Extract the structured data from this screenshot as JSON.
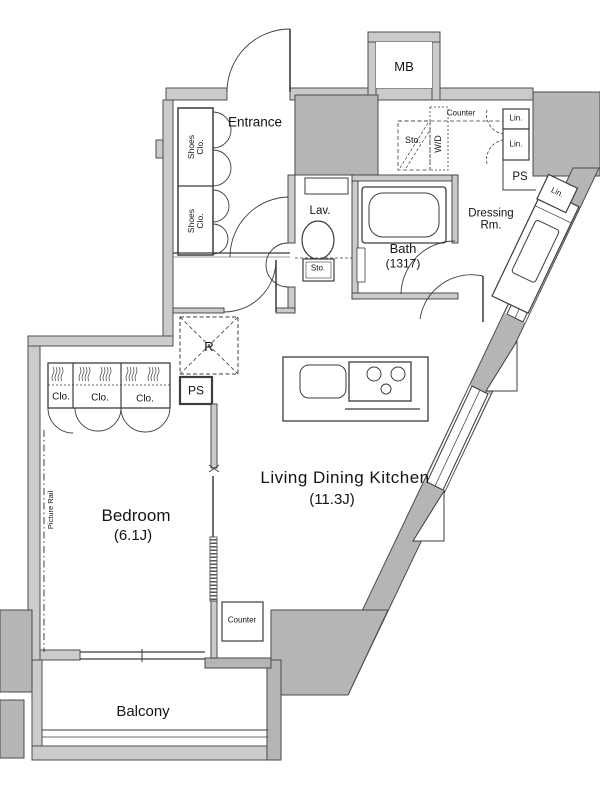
{
  "plan": {
    "rooms": {
      "entrance": "Entrance",
      "bedroom": "Bedroom",
      "bedroom_size": "(6.1J)",
      "ldk": "Living Dining Kitchen",
      "ldk_size": "(11.3J)",
      "bath": "Bath",
      "bath_size": "(1317)",
      "lav": "Lav.",
      "dressing": "Dressing Rm.",
      "balcony": "Balcony"
    },
    "features": {
      "mb": "MB",
      "counter_upper": "Counter",
      "sto_upper": "Sto.",
      "wd": "W/D",
      "lin_1": "Lin.",
      "lin_2": "Lin.",
      "lin_3": "Lin.",
      "ps_upper": "PS",
      "ps_lower": "PS",
      "sto_lav": "Sto.",
      "fridge": "R",
      "clo_1": "Clo.",
      "clo_2": "Clo.",
      "clo_3": "Clo.",
      "shoes_clo_1": "Shoes Clo.",
      "shoes_clo_2": "Shoes Clo.",
      "picture_rail": "Picture Rail",
      "counter_lower": "Counter"
    },
    "colors": {
      "background": "#ffffff",
      "wall_light": "#cbcbcb",
      "wall_solid": "#b5b5b5",
      "line": "#3c3c3c"
    }
  }
}
